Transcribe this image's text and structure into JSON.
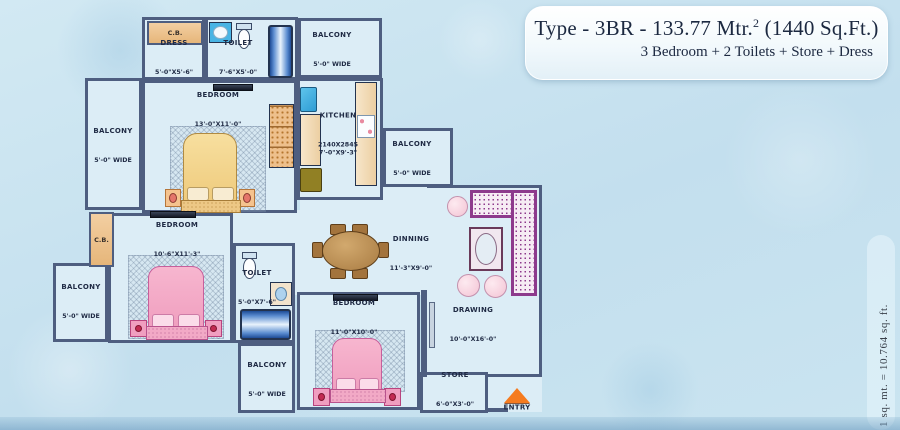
{
  "title": {
    "line1_pre": "Type - 3BR - 133.77 Mtr.",
    "line1_sup": "2",
    "line1_post": " (1440 Sq.Ft.)",
    "line2": "3 Bedroom + 2 Toilets + Store + Dress"
  },
  "note_vertical": "1 sq. mt. = 10.764 sq. ft.",
  "cb_label": "C.B.",
  "entry_label": "ENTRY",
  "rooms": {
    "dress": {
      "name": "DRESS",
      "size": "5'-0\"X5'-6\""
    },
    "toilet_top": {
      "name": "TOILET",
      "size": "7'-6\"X5'-0\""
    },
    "balcony_top": {
      "name": "BALCONY",
      "size": "5'-0\" WIDE"
    },
    "balcony_left_top": {
      "name": "BALCONY",
      "size": "5'-0\" WIDE"
    },
    "bedroom1": {
      "name": "BEDROOM",
      "size": "13'-0\"X11'-0\""
    },
    "kitchen": {
      "name": "KITCHEN",
      "size": "2140X2845\n7'-0\"X9'-3\""
    },
    "balcony_right": {
      "name": "BALCONY",
      "size": "5'-0\" WIDE"
    },
    "bedroom2": {
      "name": "BEDROOM",
      "size": "10'-6\"X11'-3\""
    },
    "toilet_mid": {
      "name": "TOILET",
      "size": "5'-0\"X7'-6\""
    },
    "balcony_left_bottom": {
      "name": "BALCONY",
      "size": "5'-0\" WIDE"
    },
    "dinning": {
      "name": "DINNING",
      "size": "11'-3\"X9'-0\""
    },
    "drawing": {
      "name": "DRAWING",
      "size": "10'-0\"X16'-0\""
    },
    "bedroom3": {
      "name": "BEDROOM",
      "size": "11'-0\"X10'-0\""
    },
    "balcony_bottom": {
      "name": "BALCONY",
      "size": "5'-0\" WIDE"
    },
    "store": {
      "name": "STORE",
      "size": "6'-0\"X3'-0\""
    }
  },
  "colors": {
    "wall": "#4e5e80",
    "floor": "#dcedf6",
    "background": "#c9e3ef",
    "bed_pink": "#ef9cbd",
    "bed_yellow": "#eec878",
    "sofa_purple": "#8d3a8c",
    "entry_orange": "#f57b1f",
    "appliance_blue": "#2e9cd4",
    "counter_tan": "#eccfa2",
    "title_text": "#1b2840"
  }
}
